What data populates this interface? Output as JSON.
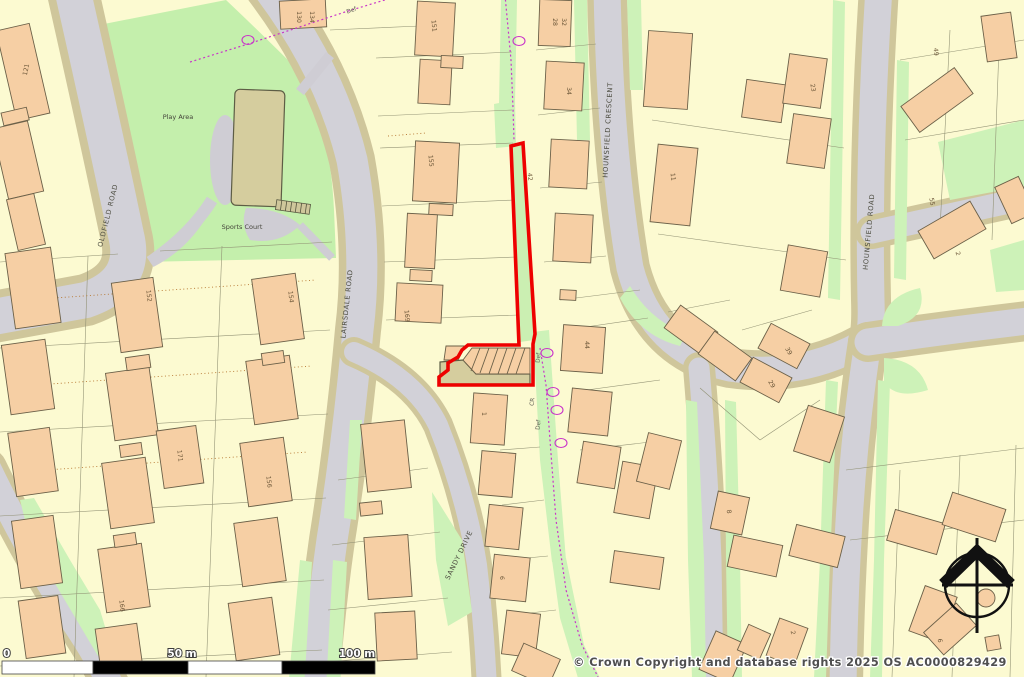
{
  "map": {
    "street_labels": [
      {
        "text": "OLDFIELD ROAD",
        "x": 110,
        "y": 216,
        "rot": -76
      },
      {
        "text": "LAIRSDALE ROAD",
        "x": 349,
        "y": 304,
        "rot": -84
      },
      {
        "text": "HOUNSFIELD CRESCENT",
        "x": 610,
        "y": 130,
        "rot": -87
      },
      {
        "text": "HOUNSFIELD ROAD",
        "x": 871,
        "y": 232,
        "rot": -85
      },
      {
        "text": "SANDY DRIVE",
        "x": 461,
        "y": 556,
        "rot": -64
      }
    ],
    "area_labels": [
      {
        "text": "Play Area",
        "x": 178,
        "y": 119,
        "rot": 0
      },
      {
        "text": "Sports Court",
        "x": 242,
        "y": 229,
        "rot": 0
      }
    ],
    "boundary_labels": [
      {
        "text": "Def",
        "x": 352,
        "y": 12,
        "rot": -20
      },
      {
        "text": "Def",
        "x": 540,
        "y": 358,
        "rot": -85
      },
      {
        "text": "CR",
        "x": 534,
        "y": 402,
        "rot": -85
      },
      {
        "text": "Def",
        "x": 540,
        "y": 425,
        "rot": -85
      }
    ],
    "house_numbers": [
      {
        "text": "121",
        "x": 28,
        "y": 70,
        "rot": -78
      },
      {
        "text": "130",
        "x": 297,
        "y": 17,
        "rot": 90
      },
      {
        "text": "134",
        "x": 310,
        "y": 17,
        "rot": 90
      },
      {
        "text": "151",
        "x": 432,
        "y": 26,
        "rot": 85
      },
      {
        "text": "155",
        "x": 429,
        "y": 161,
        "rot": 85
      },
      {
        "text": "169",
        "x": 405,
        "y": 316,
        "rot": 85
      },
      {
        "text": "42",
        "x": 528,
        "y": 177,
        "rot": 85
      },
      {
        "text": "28",
        "x": 553,
        "y": 22,
        "rot": 90
      },
      {
        "text": "32",
        "x": 562,
        "y": 22,
        "rot": 90
      },
      {
        "text": "34",
        "x": 567,
        "y": 91,
        "rot": 90
      },
      {
        "text": "44",
        "x": 585,
        "y": 345,
        "rot": 90
      },
      {
        "text": "1",
        "x": 482,
        "y": 414,
        "rot": 90
      },
      {
        "text": "6",
        "x": 500,
        "y": 578,
        "rot": 90
      },
      {
        "text": "11",
        "x": 671,
        "y": 177,
        "rot": 85
      },
      {
        "text": "23",
        "x": 811,
        "y": 88,
        "rot": 80
      },
      {
        "text": "39",
        "x": 787,
        "y": 352,
        "rot": 60
      },
      {
        "text": "29",
        "x": 770,
        "y": 385,
        "rot": 60
      },
      {
        "text": "8",
        "x": 727,
        "y": 512,
        "rot": 80
      },
      {
        "text": "49",
        "x": 934,
        "y": 52,
        "rot": 85
      },
      {
        "text": "55",
        "x": 930,
        "y": 202,
        "rot": 80
      },
      {
        "text": "2",
        "x": 956,
        "y": 254,
        "rot": 75
      },
      {
        "text": "152",
        "x": 147,
        "y": 296,
        "rot": 84
      },
      {
        "text": "154",
        "x": 289,
        "y": 297,
        "rot": 84
      },
      {
        "text": "171",
        "x": 178,
        "y": 456,
        "rot": 84
      },
      {
        "text": "156",
        "x": 267,
        "y": 482,
        "rot": 84
      },
      {
        "text": "166",
        "x": 120,
        "y": 606,
        "rot": 84
      },
      {
        "text": "2",
        "x": 791,
        "y": 633,
        "rot": 80
      },
      {
        "text": "6",
        "x": 938,
        "y": 641,
        "rot": 80
      }
    ]
  },
  "scale_bar": {
    "zero": "0",
    "fifty": "50 m",
    "hundred": "100 m"
  },
  "attribution": "© Crown Copyright and database rights 2025 OS AC0000829429",
  "colors": {
    "site_boundary": "#EE0000",
    "admin_boundary": "#C935C9",
    "building": "#F6CFA4",
    "road_surface": "#D2D1D8",
    "road_verge": "#CFC69B",
    "greenspace": "#CDF2B8",
    "parcel": "#FCFAD1",
    "sports_court": "#D5CD9E"
  }
}
